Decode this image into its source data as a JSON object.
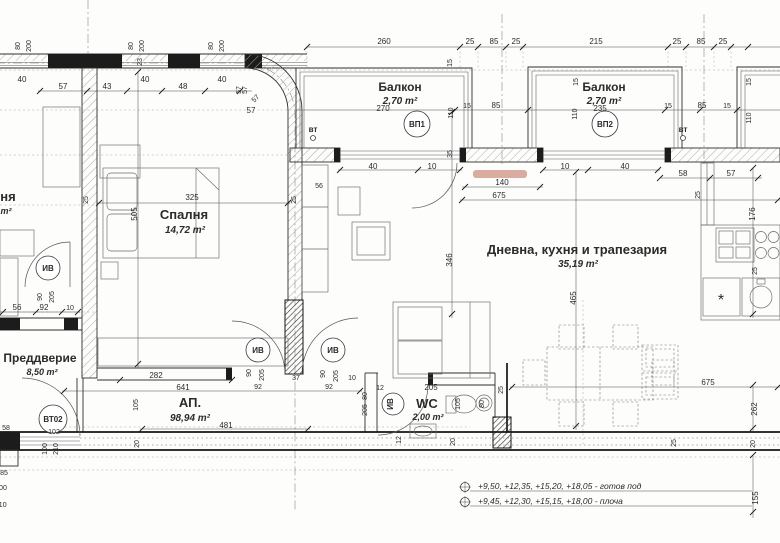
{
  "plan": {
    "rooms": {
      "balcony1": {
        "name": "Балкон",
        "area": "2,70 m²"
      },
      "balcony2": {
        "name": "Балкон",
        "area": "2,70 m²"
      },
      "bedroom": {
        "name": "Спалня",
        "area": "14,72 m²"
      },
      "living": {
        "name": "Дневна, кухня и трапезария",
        "area": "35,19 m²"
      },
      "entry": {
        "name": "Преддверие",
        "area": "8,50 m²"
      },
      "wc": {
        "name": "WC",
        "area": "2,00 m²"
      },
      "apartment": {
        "name": "АП.",
        "area": "98,94 m²"
      },
      "neighbor": {
        "name": "ня",
        "area": "m²"
      }
    },
    "tags": {
      "vp1": "ВП1",
      "vp2": "ВП2",
      "iv": "ИВ",
      "vt02": "ВТ02",
      "vt02_num": "102",
      "vent": "вт",
      "asterisk": "*"
    },
    "levels": {
      "floor_line": "+9,50, +12,35, +15,20, +18,05 - готов под",
      "slab_line": "+9,45, +12,30, +15,15, +18,00 - плоча"
    },
    "dims": {
      "d10": "10",
      "d12": "12",
      "d15": "15",
      "d20": "20",
      "d23": "23",
      "d25": "25",
      "d35": "35",
      "d37": "37",
      "d40": "40",
      "d43": "43",
      "d48": "48",
      "d56": "56",
      "d57": "57",
      "d58": "58",
      "d80": "80",
      "d85": "85",
      "d90": "90",
      "d92": "92",
      "d100": "100",
      "d105": "105",
      "d110": "110",
      "d140": "140",
      "d155": "155",
      "d176": "176",
      "d200": "200",
      "d205": "205",
      "d210": "210",
      "d215": "215",
      "d235": "235",
      "d260": "260",
      "d262": "262",
      "d270": "270",
      "d282": "282",
      "d325": "325",
      "d346": "346",
      "d465": "465",
      "d481": "481",
      "d505": "505",
      "d641": "641",
      "d675": "675"
    }
  }
}
